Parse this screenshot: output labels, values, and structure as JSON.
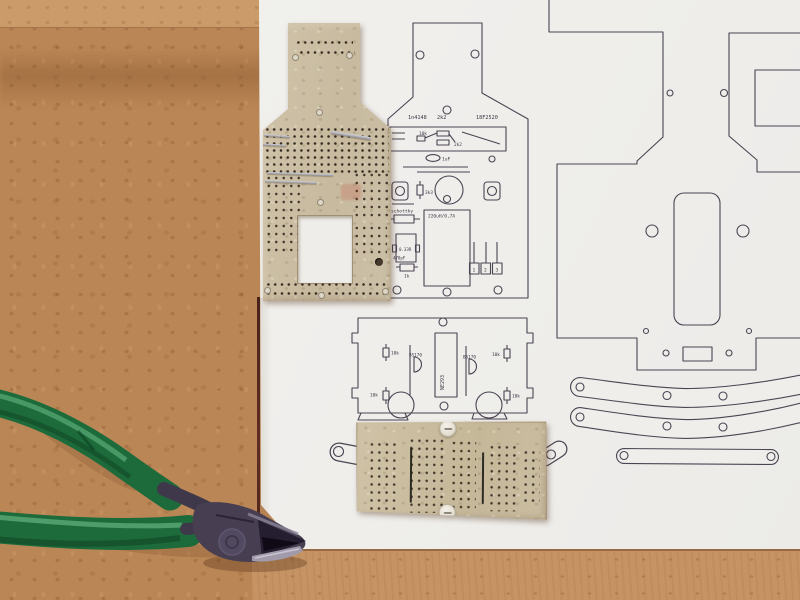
{
  "print": {
    "line_color": "#4b4452",
    "board1": {
      "d1n4148": "1n4148",
      "r2k2_top": "2k2",
      "mcu": "18F2520",
      "r10k": "10k",
      "r2k2": "2k2",
      "c1uf": "1uF",
      "r3k3": "3k3",
      "schottky": "schottky",
      "inductor": "220uH/0,7A",
      "rsense": "0.33R",
      "ct": "470pF",
      "r1k": "1k",
      "pin1": "1",
      "pin2": "2",
      "pin3": "3"
    },
    "board2": {
      "ic": "NE293",
      "q_left": "BS170",
      "q_right": "BS170",
      "r10k_tl": "10k",
      "r10k_tr": "10k",
      "r10k_bl": "10k",
      "r10k_br": "10k"
    }
  },
  "materials": {
    "paper_color": "#f0efec",
    "bench_color": "#bb8655",
    "pcb_tan_color": "#cbbea4",
    "pliers_handle_color": "#1d6b3b",
    "pliers_metal_color": "#473f51",
    "print_line_color": "#4b4452"
  }
}
